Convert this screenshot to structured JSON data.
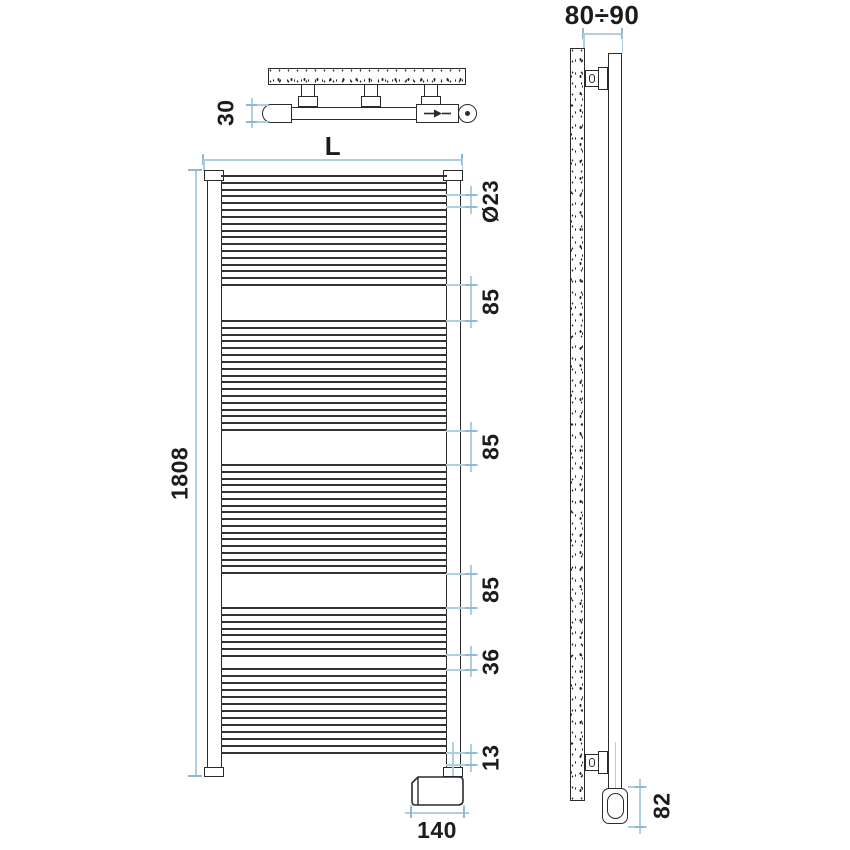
{
  "drawing": {
    "type": "towel-radiator-technical-drawing",
    "colors": {
      "line": "#2b2b2b",
      "dimension": "#aecfe2",
      "text": "#1c1c1c"
    }
  },
  "top_view": {
    "depth": "30",
    "bracket_count": 3
  },
  "front_view": {
    "width": "L",
    "height": "1808",
    "tube_diameter": "Ø23",
    "gaps": [
      "85",
      "85",
      "85"
    ],
    "rung_spacing": "36",
    "bottom_offset": "13",
    "element_width": "140",
    "rung_groups": [
      {
        "start": 175,
        "end": 284,
        "count": 17
      },
      {
        "start": 320,
        "end": 429,
        "count": 17
      },
      {
        "start": 464,
        "end": 572,
        "count": 17
      },
      {
        "start": 607,
        "end": 655,
        "count": 8
      },
      {
        "start": 668,
        "end": 752,
        "count": 13
      }
    ]
  },
  "side_view": {
    "wall_distance": "80÷90",
    "element_height": "82"
  }
}
